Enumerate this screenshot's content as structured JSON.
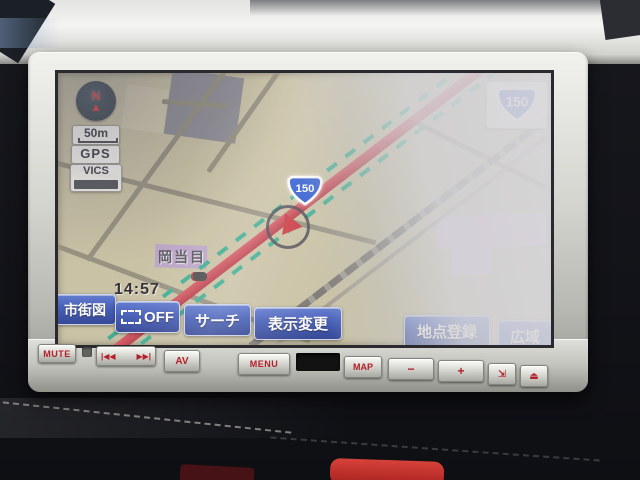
{
  "nav": {
    "compass": {
      "letter": "N",
      "needle": "▲"
    },
    "scale": "50m",
    "gps": "GPS",
    "vics": "VICS",
    "clock": "14:57",
    "corner_shield": "150",
    "map_shield": "150",
    "place": "岡当目",
    "touch_buttons": {
      "city_map": "市街図",
      "route_off": "OFF",
      "search": "サーチ",
      "display_change": "表示変更",
      "register_point": "地点登録",
      "wide_area": "広域"
    }
  },
  "hardware": {
    "mute": "MUTE",
    "seek_back": "|◀◀",
    "seek_forward": "▶▶|",
    "av": "AV",
    "menu": "MENU",
    "map": "MAP",
    "volume_down": "−",
    "volume_up": "+",
    "tilt": "⇲",
    "eject": "⏏"
  },
  "colors": {
    "touch_button_blue": "#3551b4",
    "route_red": "#b52e3e",
    "vics_flow_green": "#2fa98c",
    "map_background": "#c6bfa0",
    "shield_blue": "#1d4ed0",
    "bezel_silver": "#d4d4cf",
    "hw_text_red": "#b3202a"
  }
}
